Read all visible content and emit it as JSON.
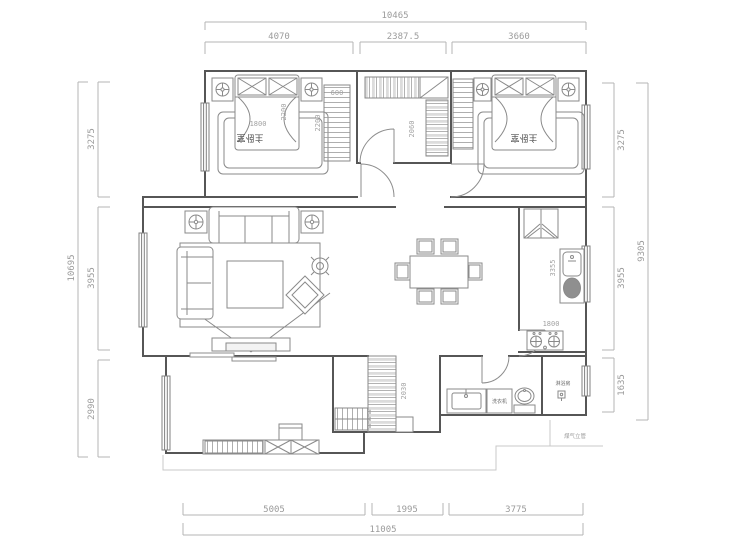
{
  "dims": {
    "top": {
      "overall": "10465",
      "segments": [
        "4070",
        "2387.5",
        "3660"
      ]
    },
    "left": {
      "overall": "10695",
      "segments": [
        "3275",
        "3955",
        "2990"
      ]
    },
    "right": {
      "overall": "9305",
      "segments": [
        "3275",
        "3955",
        "1635"
      ]
    },
    "bottom": {
      "overall": "11005",
      "segments": [
        "5005",
        "1995",
        "3775"
      ]
    }
  },
  "rooms": {
    "master_bedroom_left": {
      "label": "主卧室",
      "bed_width": "1800",
      "bed_length": "2200"
    },
    "master_bedroom_right": {
      "label": "主卧室"
    },
    "wardrobe": {
      "depth": "600",
      "length": "2200"
    },
    "hallway_closet": {
      "width": "2060"
    },
    "kitchen": {
      "counter_length": "3355",
      "counter_width": "1800"
    },
    "balcony": {
      "cabinet_height": "2030"
    },
    "bathroom": {
      "washing_machine": "洗衣机",
      "shower_room": "淋浴房",
      "note": "煤气立管"
    }
  },
  "colors": {
    "wall": "#565656",
    "furniture": "#8a8a8a",
    "dim_line": "#b4b4b4",
    "hatch_gray": "#dcdcdc"
  }
}
